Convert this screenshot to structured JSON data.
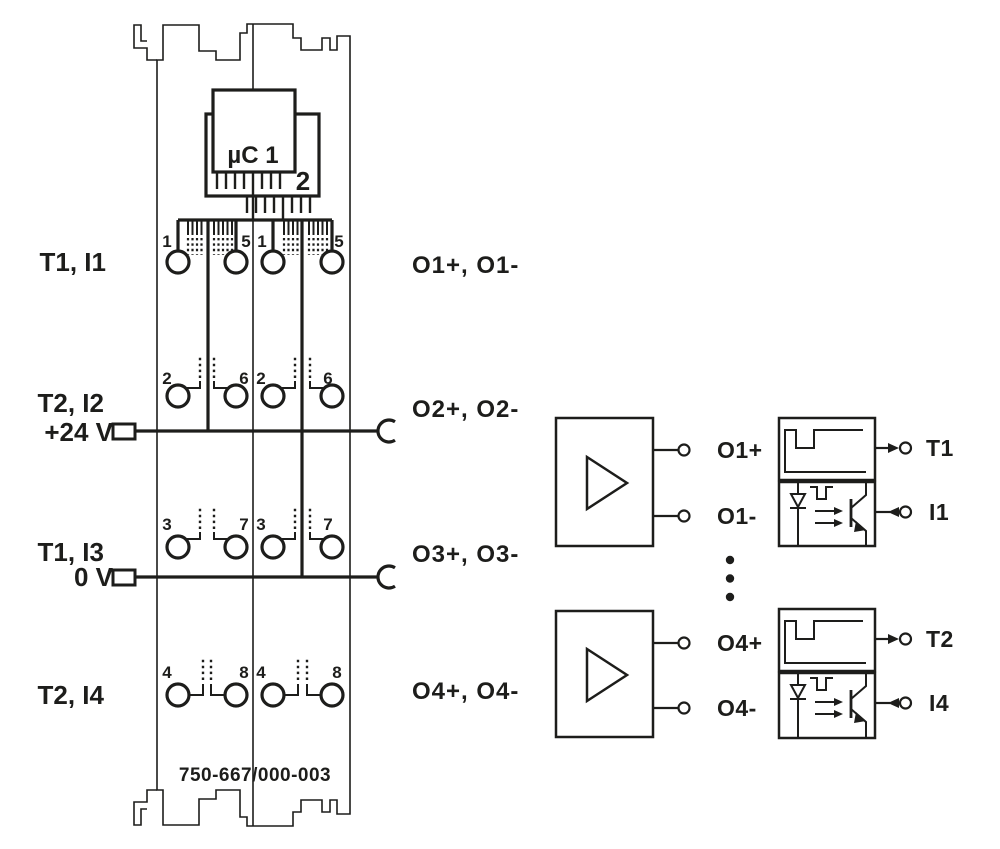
{
  "diagram": {
    "title": "I/O module internal wiring diagram",
    "background": "#ffffff",
    "line_color": "#1d1d1b",
    "part_number": "750-667/000-003",
    "microcontroller": {
      "label": "µC 1",
      "label2": "2"
    },
    "terminal_rows": [
      {
        "left_label": "T1, I1",
        "numbers": [
          "1",
          "5",
          "1",
          "5"
        ],
        "output_label": "O1+, O1-"
      },
      {
        "left_label": "T2, I2",
        "rail_label": "+24 V",
        "numbers": [
          "2",
          "6",
          "2",
          "6"
        ],
        "output_label": "O2+, O2-"
      },
      {
        "left_label": "T1, I3",
        "rail_label": "0 V",
        "numbers": [
          "3",
          "7",
          "3",
          "7"
        ],
        "output_label": "O3+, O3-"
      },
      {
        "left_label": "T2, I4",
        "numbers": [
          "4",
          "8",
          "4",
          "8"
        ],
        "output_label": "O4+, O4-"
      }
    ],
    "channels": [
      {
        "plus": "O1+",
        "minus": "O1-",
        "clock": "T1",
        "input": "I1"
      },
      {
        "plus": "O4+",
        "minus": "O4-",
        "clock": "T2",
        "input": "I4"
      }
    ]
  }
}
